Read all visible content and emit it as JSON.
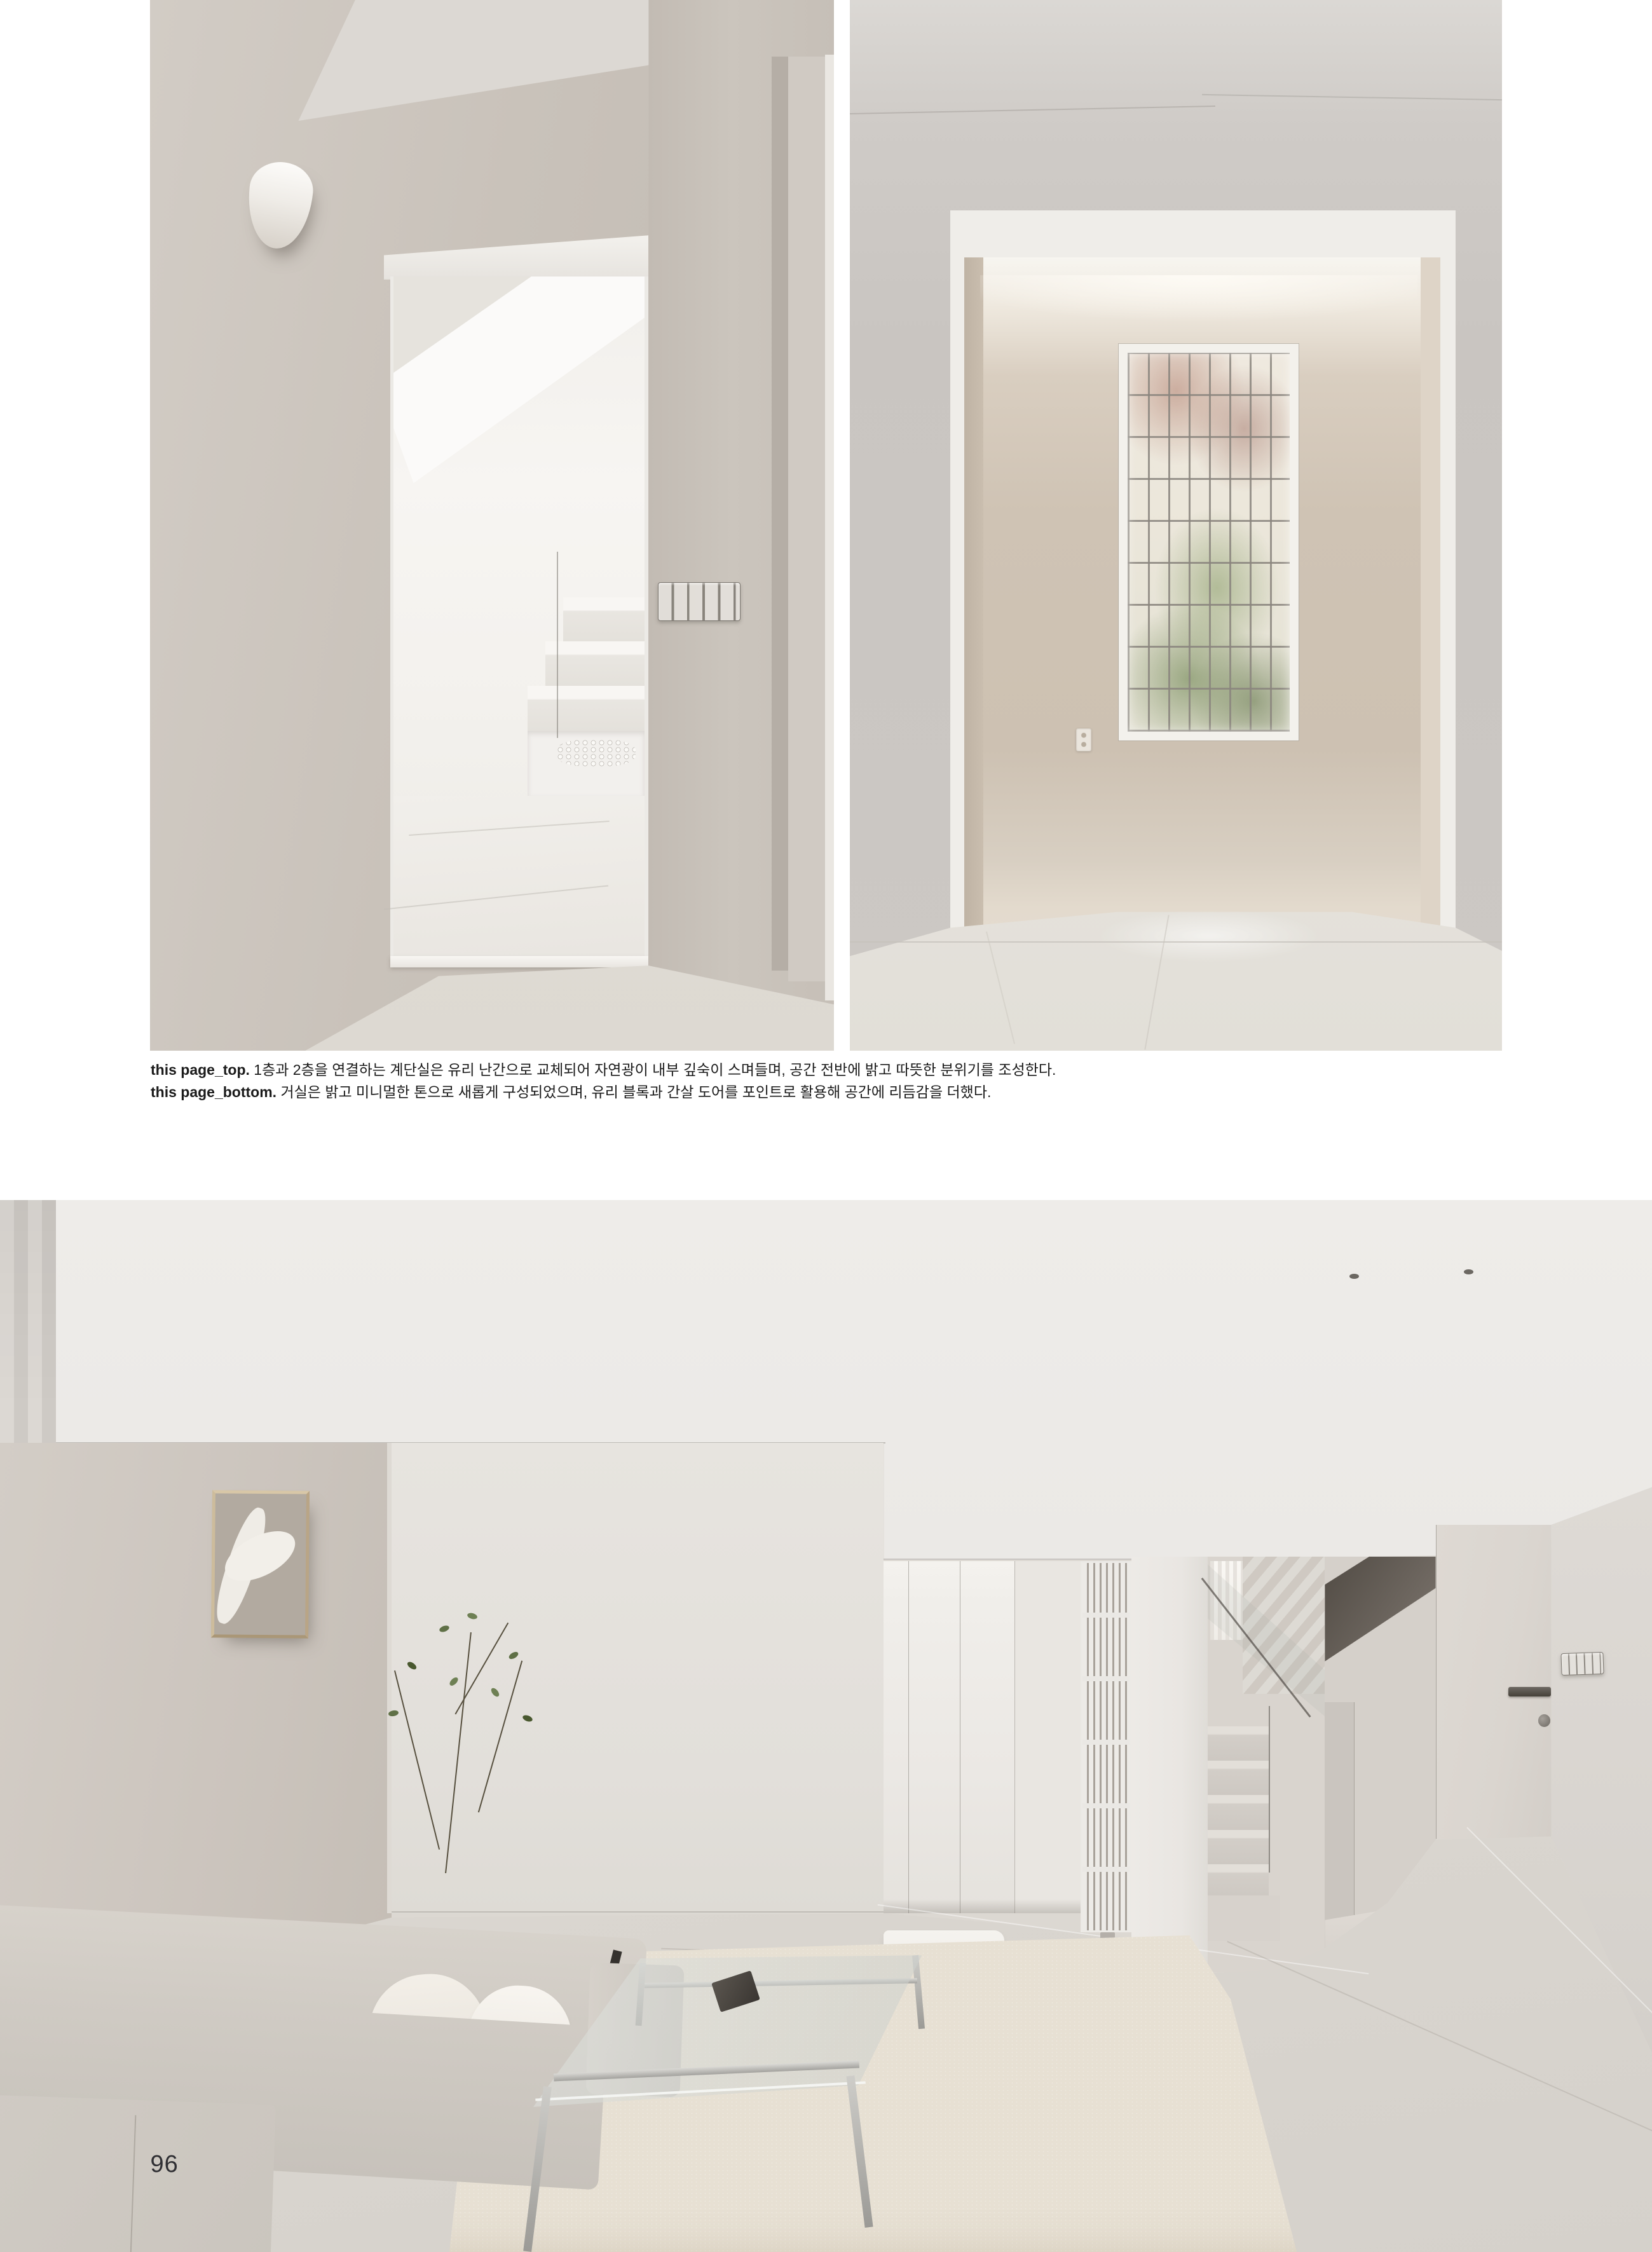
{
  "captions": {
    "top": {
      "label": "this page_top.",
      "text": " 1층과 2층을 연결하는 계단실은 유리 난간으로 교체되어 자연광이 내부 깊숙이 스며들며, 공간 전반에 밝고 따뜻한 분위기를 조성한다."
    },
    "bottom": {
      "label": "this page_bottom.",
      "text": " 거실은 밝고 미니멀한 톤으로 새롭게 구성되었으며, 유리 블록과 간살 도어를 포인트로 활용해 공간에 리듬감을 더했다."
    }
  },
  "page": {
    "number": "96"
  },
  "colors": {
    "paper": "#ffffff",
    "caption_text": "#1b1b1b",
    "page_number": "#2f2f33",
    "warm_wall": "#c9c2ba",
    "beige_wall": "#cfc3b4",
    "foliage_green": "#5f7046"
  }
}
